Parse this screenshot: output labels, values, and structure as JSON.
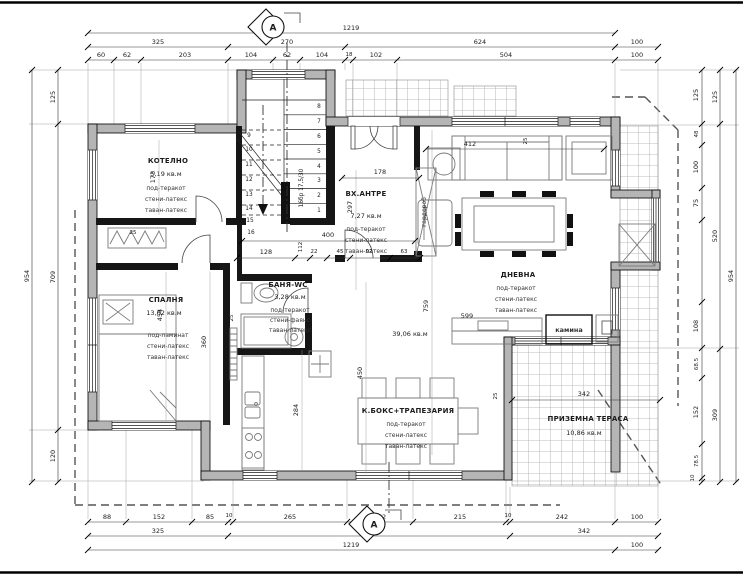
{
  "drawing": {
    "section_label": "A",
    "stair_note": "16бр 17,5/30",
    "living_area": "39,06 кв.м",
    "colors": {
      "wall_fill": "#b5b5b5",
      "line": "#1c1c1c",
      "hatch": "#a9a9a9"
    }
  },
  "rooms": {
    "kotelno": {
      "name": "КОТЕЛНО",
      "area": "5,19 кв.м",
      "fin1": "под-теракот",
      "fin2": "стени-латекс",
      "fin3": "таван-латекс"
    },
    "spalnya": {
      "name": "СПАЛНЯ",
      "area": "13,62 кв.м",
      "fin1": "под-ламинат",
      "fin2": "стени-латекс",
      "fin3": "таван-латекс"
    },
    "banya": {
      "name": "БАНЯ-WC",
      "area": "3,28 кв.м",
      "fin1": "под-теракот",
      "fin2": "стени-фаянс",
      "fin3": "таван-латекс"
    },
    "antre": {
      "name": "ВХ.АНТРЕ",
      "area": "7,27 кв.м",
      "fin1": "под-теракот",
      "fin2": "стени-латекс",
      "fin3": "таван-латекс"
    },
    "dnevna": {
      "name": "ДНЕВНА",
      "fin1": "под-теракот",
      "fin2": "стени-латекс",
      "fin3": "таван-латекс"
    },
    "kboks": {
      "name": "К.БОКС+ТРАПЕЗАРИЯ",
      "fin1": "под-теракот",
      "fin2": "стени-латекс",
      "fin3": "таван-латекс"
    },
    "terasa": {
      "name": "ПРИЗЕМНА ТЕРАСА",
      "area": "10,86 кв.м"
    },
    "kamina": {
      "name": "камина"
    },
    "garderob": {
      "name": "гардероб"
    }
  },
  "stairs": {
    "numbers": [
      "1",
      "2",
      "3",
      "4",
      "5",
      "6",
      "7",
      "8",
      "9",
      "10",
      "11",
      "12",
      "13",
      "14",
      "15",
      "16"
    ]
  },
  "dims": {
    "top1": [
      "1219"
    ],
    "top2": [
      "325",
      "270",
      "624",
      "100"
    ],
    "top3": [
      "60",
      "62",
      "203",
      "104",
      "62",
      "104",
      "18",
      "102",
      "504",
      "100"
    ],
    "bot1": [
      "88",
      "152",
      "85",
      "10",
      "265",
      "152",
      "215",
      "10",
      "242",
      "100"
    ],
    "bot2": [
      "325",
      "652",
      "342"
    ],
    "bot3": [
      "1219",
      "100"
    ],
    "left_overall": "954",
    "left": [
      "125",
      "709",
      "120"
    ],
    "right_overall": "954",
    "right_mid": [
      "125",
      "520",
      "309"
    ],
    "right": [
      "125",
      "48",
      "100",
      "75",
      "108",
      "68.5",
      "152",
      "78.5",
      "10"
    ],
    "interior": {
      "d173": "173",
      "d454": "454",
      "d360": "360",
      "d297": "297",
      "d178": "178",
      "d400": "400",
      "d412": "412",
      "d450": "450",
      "d284": "284",
      "d759": "759",
      "d599": "599",
      "d342": "342",
      "d128": "128",
      "d112": "112",
      "d22": "22",
      "d45": "45",
      "d92": "92",
      "d63": "63",
      "d25a": "25",
      "d25b": "25",
      "d25c": "25",
      "d25d": "25"
    }
  }
}
